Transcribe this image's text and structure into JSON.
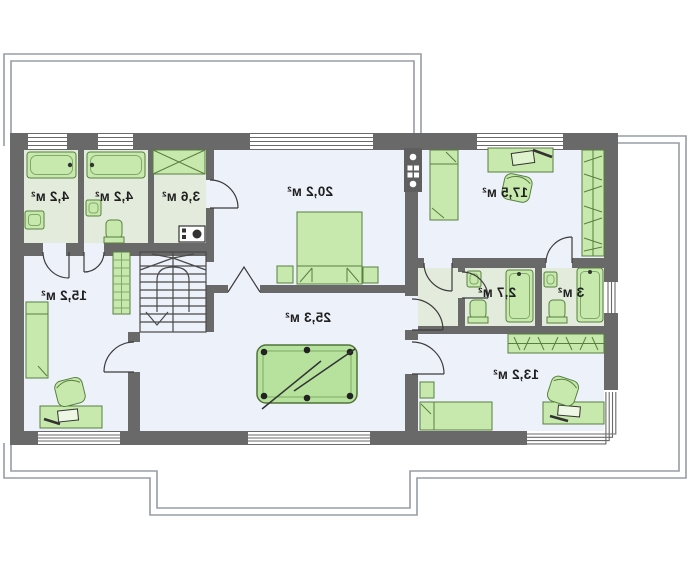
{
  "plan": {
    "type": "floor-plan",
    "mirrored_text": true,
    "rooms": [
      {
        "id": "bathroom-top-left",
        "area_label": "4,2 м²",
        "furniture": [
          "bathtub",
          "washbasin"
        ]
      },
      {
        "id": "bathroom-top-middle",
        "area_label": "4,2 м²",
        "furniture": [
          "bathtub",
          "washbasin",
          "toilet"
        ]
      },
      {
        "id": "wardrobe-closet",
        "area_label": "3,6 м²",
        "furniture": [
          "wardrobe",
          "washing-machine"
        ]
      },
      {
        "id": "bedroom-master",
        "area_label": "20,2 м²",
        "furniture": [
          "double-bed",
          "nightstand",
          "nightstand"
        ]
      },
      {
        "id": "bedroom-right",
        "area_label": "17,5 м²",
        "furniture": [
          "single-bed",
          "desk",
          "chair",
          "wardrobe"
        ]
      },
      {
        "id": "bedroom-left",
        "area_label": "15,2 м²",
        "furniture": [
          "single-bed",
          "desk",
          "chair",
          "shelving"
        ]
      },
      {
        "id": "games-room",
        "area_label": "25,3 м²",
        "furniture": [
          "billiard-table"
        ]
      },
      {
        "id": "wc",
        "area_label": "2,7 м²",
        "furniture": [
          "washbasin",
          "toilet",
          "shower"
        ]
      },
      {
        "id": "shower-room",
        "area_label": "3 м²",
        "furniture": [
          "washbasin",
          "toilet",
          "shower"
        ]
      },
      {
        "id": "bedroom-bottom-right",
        "area_label": "13,2 м²",
        "furniture": [
          "single-bed",
          "nightstand",
          "desk",
          "chair",
          "wardrobe"
        ]
      }
    ],
    "colors": {
      "wallColor": "#696969",
      "floorMain": "#edf1f9",
      "floorWet": "#e3ecdc",
      "furnitureFill": "#c8e9ae",
      "furnitureBorder": "#57803f",
      "tableFill": "#b7e29d",
      "outlineColor": "#969da6",
      "labelColor": "#1f1f1f",
      "windowLine": "#6a6a6a"
    }
  }
}
